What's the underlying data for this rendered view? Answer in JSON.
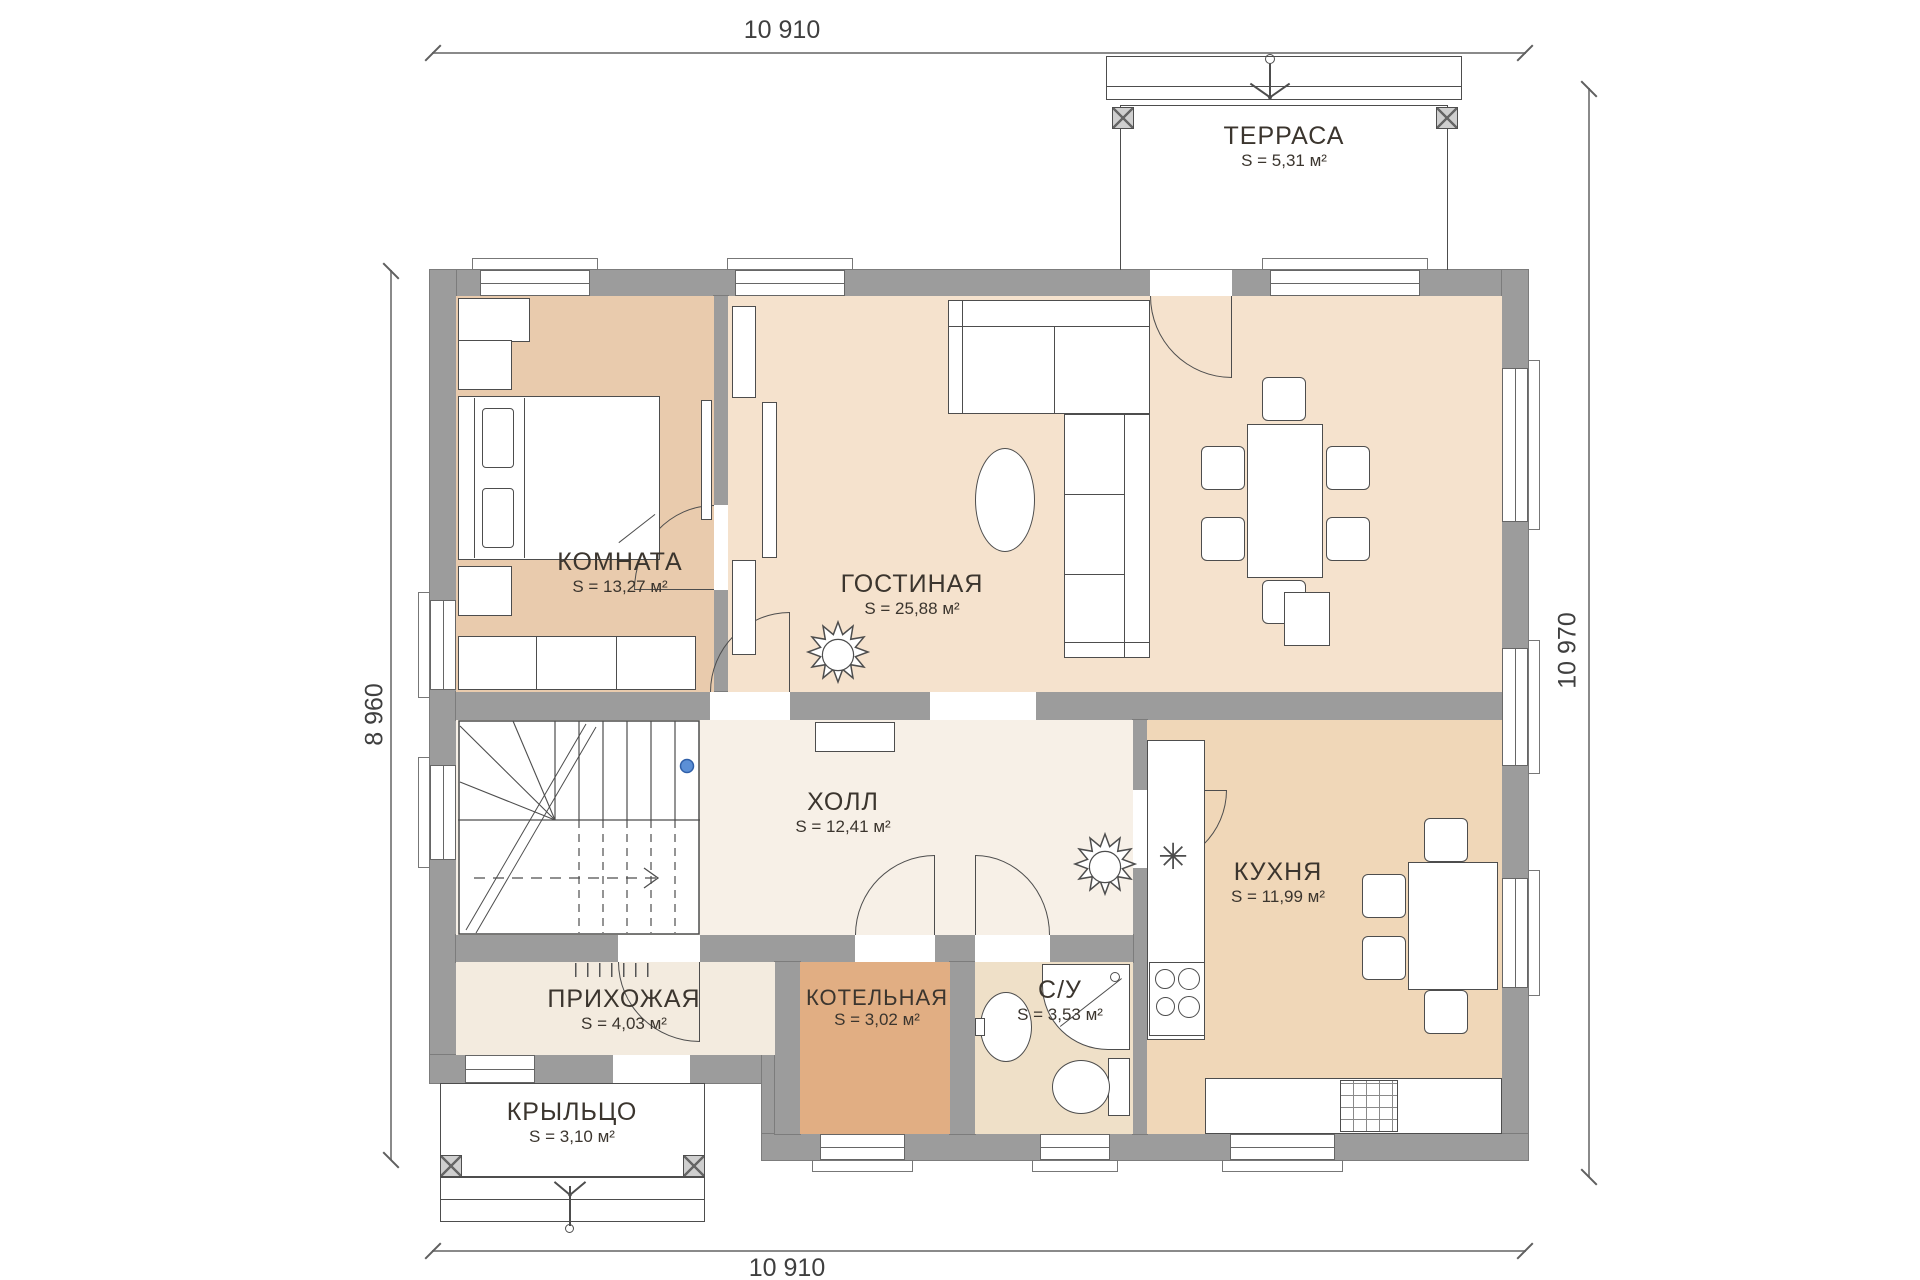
{
  "dimensions": {
    "top": "10 910",
    "bottom": "10 910",
    "left": "8 960",
    "right": "10 970"
  },
  "rooms": {
    "terrace": {
      "name": "ТЕРРАСА",
      "area": "S = 5,31 м²"
    },
    "bedroom": {
      "name": "КОМНАТА",
      "area": "S = 13,27 м²"
    },
    "living": {
      "name": "ГОСТИНАЯ",
      "area": "S = 25,88 м²"
    },
    "hall": {
      "name": "ХОЛЛ",
      "area": "S = 12,41 м²"
    },
    "kitchen": {
      "name": "КУХНЯ",
      "area": "S = 11,99 м²"
    },
    "entry": {
      "name": "ПРИХОЖАЯ",
      "area": "S = 4,03 м²"
    },
    "boiler": {
      "name": "КОТЕЛЬНАЯ",
      "area": "S = 3,02 м²"
    },
    "bath": {
      "name": "С/У",
      "area": "S = 3,53 м²"
    },
    "porch": {
      "name": "КРЫЛЬЦО",
      "area": "S = 3,10 м²"
    }
  },
  "icons": {
    "sink": "✳"
  },
  "colors": {
    "wall": "#9c9c9c",
    "line": "#4d4d4d",
    "ink": "#3b352e",
    "dim": "#3f3f3f",
    "bedroom": "#e9cbad",
    "living": "#f5e2cd",
    "kitchen": "#f0d7b8",
    "hall": "#f7f0e7",
    "entry": "#f3ebdf",
    "boiler": "#e1ae83",
    "bath": "#efe0c8",
    "dot": "#5b8fd6"
  }
}
